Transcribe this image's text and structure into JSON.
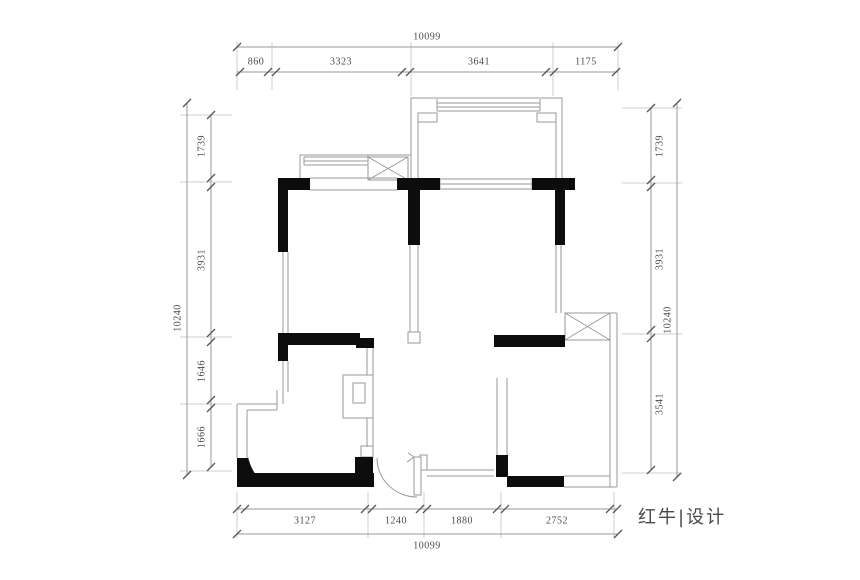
{
  "drawing": {
    "kind": "residential floor plan",
    "colors": {
      "background": "#ffffff",
      "structural_wall": "#0d0d0d",
      "thin_wall_line": "#9a9a9a",
      "dimension_line": "#9a9a9a",
      "dimension_tick": "#555555",
      "dimension_text": "#4a4a4a"
    }
  },
  "dimensions": {
    "top": {
      "total": "10099",
      "segments": [
        "860",
        "3323",
        "3641",
        "1175"
      ]
    },
    "bottom": {
      "total": "10099",
      "segments": [
        "3127",
        "1240",
        "1880",
        "2752"
      ]
    },
    "left": {
      "total": "10240",
      "segments": [
        "1739",
        "3931",
        "1646",
        "1666"
      ]
    },
    "right": {
      "total": "10240",
      "segments": [
        "1739",
        "3931",
        "3541"
      ]
    }
  },
  "logo": {
    "text": "红牛|设计"
  }
}
